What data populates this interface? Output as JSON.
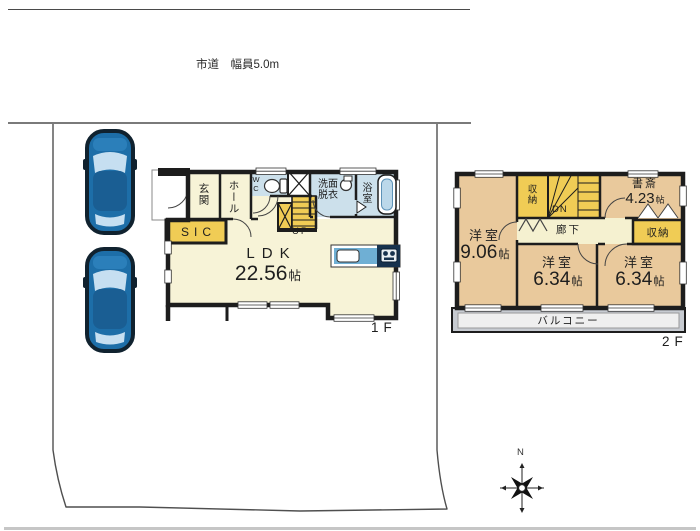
{
  "road_label": "市道　幅員5.0m",
  "floor1": {
    "label": "1F",
    "genkan": "玄関",
    "hall": "ホール",
    "wc": "WC",
    "washroom_line1": "洗面",
    "washroom_line2": "脱衣",
    "bath": "浴室",
    "sic": "SIC",
    "up": "UP",
    "ldk_name": "LDK",
    "ldk_size": "22.56",
    "ldk_unit": "帖"
  },
  "floor2": {
    "label": "2F",
    "closet_top": "収納",
    "dn": "DN",
    "study_name": "書斎",
    "study_size": "4.23",
    "study_unit": "帖",
    "closet_right": "収納",
    "corridor": "廊下",
    "bedroom_left_name": "洋室",
    "bedroom_left_size": "9.06",
    "bedroom_left_unit": "帖",
    "bedroom_center_name": "洋室",
    "bedroom_center_size": "6.34",
    "bedroom_center_unit": "帖",
    "bedroom_right_name": "洋室",
    "bedroom_right_size": "6.34",
    "bedroom_right_unit": "帖",
    "balcony": "バルコニー"
  },
  "compass": {
    "north": "N"
  },
  "colors": {
    "wall": "#1d1d1d",
    "room_cream": "#F7F3D7",
    "room_tan": "#E9C99C",
    "closet_yellow": "#F0CC55",
    "wet_blue": "#CCE0EB",
    "kitchen_blue": "#6FAFD4",
    "kitchen_navy": "#17324E",
    "balcony_gray": "#C7CBD1",
    "car_blue": "#1D6EA8",
    "boundary_gray": "#4f4f4f"
  }
}
